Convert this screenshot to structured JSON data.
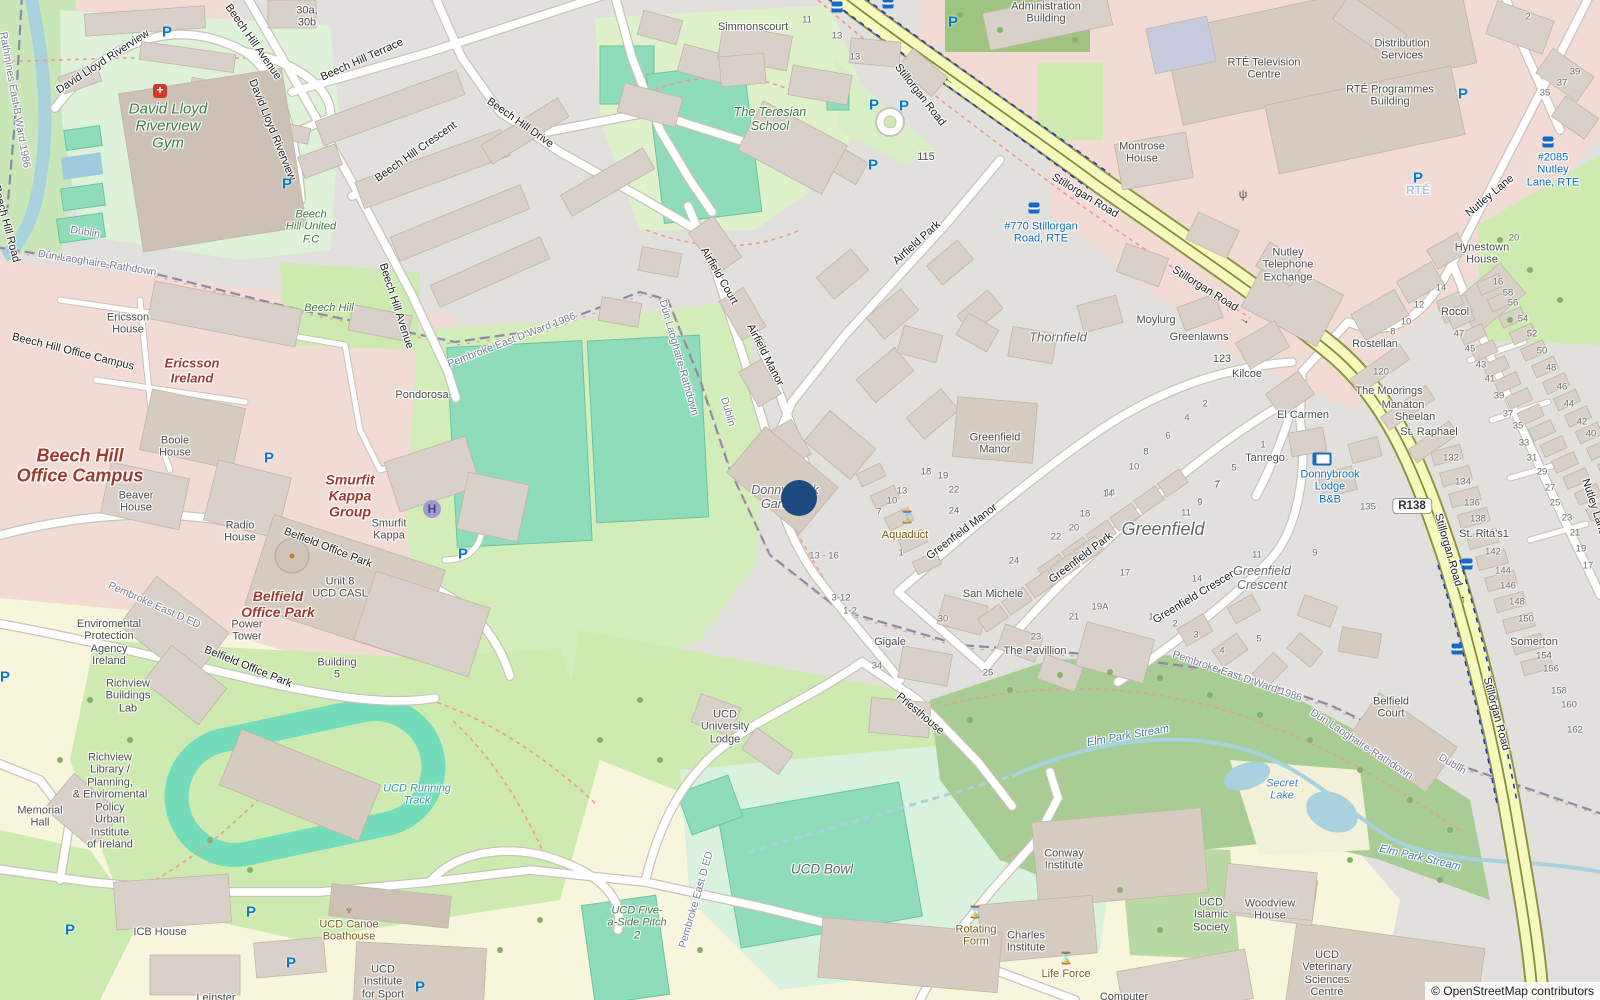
{
  "attribution": "© OpenStreetMap contributors",
  "road_ref": "R138",
  "marker": {
    "x": 799,
    "y": 498,
    "color": "#1c4980"
  },
  "colors": {
    "secondary_road": "#f5f9bb",
    "road_casing": "#8f9447",
    "pitch": "#8fdcba",
    "water": "#a9d2de",
    "commercial_pink": "#f2dbd5",
    "grass": "#cdebb0",
    "campus_yellow": "#f8f5dd",
    "wood": "#a7cd95",
    "building": "#d9d0c9"
  },
  "icon_glyphs": {
    "parking": "P",
    "helipad": "H",
    "monument": "⌛",
    "firstaid": "+",
    "antenna": "ψ",
    "boat": "♆",
    "arrow": "→"
  },
  "labels": [
    {
      "t": "David Lloyd Riverview",
      "x": 103,
      "y": 62,
      "r": -33,
      "c": "st"
    },
    {
      "t": "David Lloyd Riverview",
      "x": 272,
      "y": 130,
      "r": 68,
      "c": "st"
    },
    {
      "t": "Beech Hill Avenue",
      "x": 253,
      "y": 42,
      "r": 55,
      "c": "st"
    },
    {
      "t": "Beech Hill Avenue",
      "x": 396,
      "y": 306,
      "r": 72,
      "c": "st"
    },
    {
      "t": "Beech Hill Terrace",
      "x": 362,
      "y": 60,
      "r": -24,
      "c": "st"
    },
    {
      "t": "Beech Hill Crescent",
      "x": 416,
      "y": 152,
      "r": -35,
      "c": "st"
    },
    {
      "t": "Beech Hill Drive",
      "x": 520,
      "y": 123,
      "r": 35,
      "c": "st"
    },
    {
      "t": "Beech Hill Road",
      "x": 6,
      "y": 224,
      "r": 75,
      "c": "st"
    },
    {
      "t": "Beech Hill Office Campus",
      "x": 73,
      "y": 352,
      "r": 14,
      "c": "st"
    },
    {
      "t": "Belfield Office Park",
      "x": 328,
      "y": 548,
      "r": 21,
      "c": "st"
    },
    {
      "t": "Belfield Office Park",
      "x": 248,
      "y": 667,
      "r": 22,
      "c": "st"
    },
    {
      "t": "Stillorgan Road",
      "x": 920,
      "y": 95,
      "r": 52,
      "c": "st"
    },
    {
      "t": "Stillorgan Road",
      "x": 1085,
      "y": 196,
      "r": 31,
      "c": "st"
    },
    {
      "t": "Stillorgan Road",
      "x": 1205,
      "y": 289,
      "r": 32,
      "c": "st"
    },
    {
      "t": "Stillorgan Road",
      "x": 1448,
      "y": 550,
      "r": 74,
      "c": "st"
    },
    {
      "t": "Stillorgan Road",
      "x": 1496,
      "y": 714,
      "r": 75,
      "c": "st"
    },
    {
      "t": "Nutley Lane",
      "x": 1490,
      "y": 196,
      "r": -40,
      "c": "st"
    },
    {
      "t": "Nutley Lane",
      "x": 1594,
      "y": 507,
      "r": 72,
      "c": "st"
    },
    {
      "t": "Airfield Park",
      "x": 917,
      "y": 243,
      "r": -42,
      "c": "st"
    },
    {
      "t": "Airfield Court",
      "x": 719,
      "y": 276,
      "r": 60,
      "c": "st"
    },
    {
      "t": "Airfield Manor",
      "x": 765,
      "y": 355,
      "r": 63,
      "c": "st"
    },
    {
      "t": "Greenfield Manor",
      "x": 962,
      "y": 532,
      "r": -37,
      "c": "st"
    },
    {
      "t": "Greenfield Park",
      "x": 1081,
      "y": 558,
      "r": -37,
      "c": "st"
    },
    {
      "t": "Greenfield Crescent",
      "x": 1196,
      "y": 596,
      "r": -31,
      "c": "st"
    },
    {
      "t": "Priesthouse",
      "x": 920,
      "y": 714,
      "r": 40,
      "c": "st"
    },
    {
      "t": "Rathmines East B Ward 1986",
      "x": 14,
      "y": 100,
      "r": 80,
      "c": "bd"
    },
    {
      "t": "Dublin",
      "x": 85,
      "y": 233,
      "r": 9,
      "c": "bd"
    },
    {
      "t": "Dún Laoghaire-Rathdown",
      "x": 97,
      "y": 264,
      "r": 9,
      "c": "bd"
    },
    {
      "t": "Pembroke East D Ward 1986",
      "x": 512,
      "y": 341,
      "r": -21,
      "c": "bd"
    },
    {
      "t": "Dún Laoghaire-Rathdown",
      "x": 678,
      "y": 358,
      "r": 74,
      "c": "bd"
    },
    {
      "t": "Dublin",
      "x": 727,
      "y": 412,
      "r": 74,
      "c": "bd"
    },
    {
      "t": "Pembroke East D ED",
      "x": 154,
      "y": 606,
      "r": 24,
      "c": "bd"
    },
    {
      "t": "Pembroke East D ED",
      "x": 697,
      "y": 900,
      "r": -74,
      "c": "bd"
    },
    {
      "t": "Pembroke East D Ward 1986",
      "x": 1237,
      "y": 677,
      "r": 19,
      "c": "bd"
    },
    {
      "t": "Dún Laoghaire-Rathdown",
      "x": 1361,
      "y": 745,
      "r": 33,
      "c": "bd"
    },
    {
      "t": "Dublin",
      "x": 1452,
      "y": 765,
      "r": 31,
      "c": "bd"
    },
    {
      "t": "Simmonscourt",
      "x": 753,
      "y": 27,
      "c": "pl"
    },
    {
      "t": [
        "Administration",
        "Building"
      ],
      "x": 1046,
      "y": 13,
      "c": "pl"
    },
    {
      "t": [
        "RTÉ Television",
        "Centre"
      ],
      "x": 1264,
      "y": 69,
      "c": "pl"
    },
    {
      "t": [
        "Montrose",
        "House"
      ],
      "x": 1142,
      "y": 153,
      "c": "pl"
    },
    {
      "t": [
        "Distribution",
        "Services"
      ],
      "x": 1402,
      "y": 50,
      "c": "pl"
    },
    {
      "t": [
        "RTÉ Programmes",
        "Building"
      ],
      "x": 1390,
      "y": 96,
      "c": "pl"
    },
    {
      "t": [
        "Nutley",
        "Telephone",
        "Exchange"
      ],
      "x": 1288,
      "y": 265,
      "c": "pl"
    },
    {
      "t": [
        "Hynestown",
        "House"
      ],
      "x": 1482,
      "y": 254,
      "c": "pl"
    },
    {
      "t": "Rocol",
      "x": 1455,
      "y": 312,
      "c": "pl"
    },
    {
      "t": "Rostellan",
      "x": 1375,
      "y": 344,
      "c": "pl"
    },
    {
      "t": "The Moorings",
      "x": 1389,
      "y": 391,
      "c": "pl"
    },
    {
      "t": "Manaton",
      "x": 1403,
      "y": 405,
      "c": "pl"
    },
    {
      "t": "Sheelan",
      "x": 1415,
      "y": 417,
      "c": "pl"
    },
    {
      "t": "St. Raphael",
      "x": 1429,
      "y": 432,
      "c": "pl"
    },
    {
      "t": "St. Rita's1",
      "x": 1484,
      "y": 534,
      "c": "pl"
    },
    {
      "t": "Somerton",
      "x": 1534,
      "y": 642,
      "c": "pl"
    },
    {
      "t": "El Carmen",
      "x": 1303,
      "y": 415,
      "c": "pl"
    },
    {
      "t": "Tanrego",
      "x": 1265,
      "y": 458,
      "c": "pl"
    },
    {
      "t": "Moylurg",
      "x": 1156,
      "y": 320,
      "c": "pl"
    },
    {
      "t": "Greenlawns",
      "x": 1199,
      "y": 337,
      "c": "pl"
    },
    {
      "t": "Kilcoe",
      "x": 1247,
      "y": 374,
      "c": "pl"
    },
    {
      "t": [
        "Greenfield",
        "Manor"
      ],
      "x": 995,
      "y": 444,
      "c": "pl"
    },
    {
      "t": "San Michele",
      "x": 993,
      "y": 594,
      "c": "pl"
    },
    {
      "t": "The Pavillion",
      "x": 1035,
      "y": 651,
      "c": "pl"
    },
    {
      "t": "Gigale",
      "x": 890,
      "y": 642,
      "c": "pl"
    },
    {
      "t": "Pondorosa",
      "x": 422,
      "y": 395,
      "c": "pl"
    },
    {
      "t": [
        "30a,",
        "30b"
      ],
      "x": 307,
      "y": 17,
      "c": "pl"
    },
    {
      "t": [
        "Ericsson",
        "House"
      ],
      "x": 128,
      "y": 324,
      "c": "pl"
    },
    {
      "t": [
        "Boole",
        "House"
      ],
      "x": 175,
      "y": 447,
      "c": "pl"
    },
    {
      "t": [
        "Beaver",
        "House"
      ],
      "x": 136,
      "y": 502,
      "c": "pl"
    },
    {
      "t": [
        "Radio",
        "House"
      ],
      "x": 240,
      "y": 532,
      "c": "pl"
    },
    {
      "t": [
        "Smurfit",
        "Kappa"
      ],
      "x": 389,
      "y": 530,
      "c": "pl"
    },
    {
      "t": [
        "Unit 8",
        "UCD CASL"
      ],
      "x": 340,
      "y": 588,
      "c": "pl"
    },
    {
      "t": [
        "Power",
        "Tower"
      ],
      "x": 247,
      "y": 631,
      "c": "pl"
    },
    {
      "t": [
        "Building",
        "5"
      ],
      "x": 337,
      "y": 669,
      "c": "pl"
    },
    {
      "t": [
        "Enviromental",
        "Protection",
        "Agency",
        "Ireland"
      ],
      "x": 109,
      "y": 643,
      "c": "pl"
    },
    {
      "t": [
        "Richview",
        "Buildings",
        "Lab"
      ],
      "x": 128,
      "y": 696,
      "c": "pl"
    },
    {
      "t": [
        "Richview",
        "Library /",
        "Planning,",
        "& Enviromental",
        "Policy",
        "Urban",
        "Institute",
        "of Ireland"
      ],
      "x": 110,
      "y": 801,
      "c": "pl"
    },
    {
      "t": [
        "Memorial",
        "Hall"
      ],
      "x": 40,
      "y": 817,
      "c": "pl"
    },
    {
      "t": "ICB House",
      "x": 160,
      "y": 932,
      "c": "pl"
    },
    {
      "t": [
        "UCD",
        "Institute",
        "for Sport"
      ],
      "x": 383,
      "y": 982,
      "c": "pl"
    },
    {
      "t": "Leinster",
      "x": 216,
      "y": 998,
      "c": "pl"
    },
    {
      "t": [
        "UCD",
        "University",
        "Lodge"
      ],
      "x": 725,
      "y": 727,
      "c": "pl"
    },
    {
      "t": [
        "Conway",
        "Institute"
      ],
      "x": 1064,
      "y": 860,
      "c": "pl"
    },
    {
      "t": [
        "Charles",
        "Institute"
      ],
      "x": 1026,
      "y": 942,
      "c": "pl"
    },
    {
      "t": "Computer",
      "x": 1124,
      "y": 997,
      "c": "pl"
    },
    {
      "t": [
        "UCD",
        "Islamic",
        "Society"
      ],
      "x": 1211,
      "y": 915,
      "c": "pl"
    },
    {
      "t": [
        "Woodview",
        "House"
      ],
      "x": 1270,
      "y": 910,
      "c": "pl"
    },
    {
      "t": [
        "UCD",
        "Veterinary",
        "Sciences",
        "Centre"
      ],
      "x": 1327,
      "y": 974,
      "c": "pl"
    },
    {
      "t": [
        "Belfield",
        "Court"
      ],
      "x": 1391,
      "y": 708,
      "c": "pl"
    },
    {
      "t": [
        "David Lloyd",
        "Riverview",
        "Gym"
      ],
      "x": 168,
      "y": 127,
      "c": "gr",
      "s": 15
    },
    {
      "t": [
        "The Teresian",
        "School"
      ],
      "x": 770,
      "y": 119,
      "c": "gr",
      "s": 12.5
    },
    {
      "t": "Beech Hill",
      "x": 329,
      "y": 308,
      "c": "gr"
    },
    {
      "t": [
        "Beech",
        "Hill United",
        "F.C"
      ],
      "x": 311,
      "y": 227,
      "c": "gr"
    },
    {
      "t": [
        "UCD Five-",
        "a-Side Pitch",
        "2"
      ],
      "x": 637,
      "y": 923,
      "c": "gr"
    },
    {
      "t": [
        "Ericsson",
        "Ireland"
      ],
      "x": 192,
      "y": 371,
      "c": "mr",
      "s": 13
    },
    {
      "t": [
        "Beech Hill",
        "Office Campus"
      ],
      "x": 80,
      "y": 466,
      "c": "mr",
      "s": 18
    },
    {
      "t": [
        "Smurfit",
        "Kappa",
        "Group"
      ],
      "x": 350,
      "y": 496,
      "c": "mr",
      "s": 14
    },
    {
      "t": [
        "Belfield",
        "Office Park"
      ],
      "x": 278,
      "y": 605,
      "c": "mr",
      "s": 14
    },
    {
      "t": "Greenfield",
      "x": 1163,
      "y": 529,
      "c": "lc"
    },
    {
      "t": "Thornfield",
      "x": 1058,
      "y": 338,
      "c": "ls",
      "s": 13
    },
    {
      "t": [
        "Greenfield",
        "Crescent"
      ],
      "x": 1262,
      "y": 578,
      "c": "ls"
    },
    {
      "t": [
        "Donnybrook",
        "Gardens"
      ],
      "x": 785,
      "y": 497,
      "c": "ls"
    },
    {
      "t": "UCD Bowl",
      "x": 822,
      "y": 869,
      "c": "ls",
      "s": 13.5
    },
    {
      "t": [
        "UCD Running",
        "Track"
      ],
      "x": 417,
      "y": 795,
      "c": "tl"
    },
    {
      "t": [
        "Secret",
        "Lake"
      ],
      "x": 1282,
      "y": 790,
      "c": "wt"
    },
    {
      "t": "Elm Park Stream",
      "x": 1128,
      "y": 736,
      "r": -10,
      "c": "wt"
    },
    {
      "t": "Elm Park Stream",
      "x": 1420,
      "y": 858,
      "r": 13,
      "c": "wt"
    },
    {
      "t": [
        "#770 Stillorgan",
        "Road, RTE"
      ],
      "x": 1041,
      "y": 233,
      "c": "bp"
    },
    {
      "t": [
        "#2085",
        "Nutley",
        "Lane, RTE"
      ],
      "x": 1553,
      "y": 170,
      "c": "bp"
    },
    {
      "t": [
        "Donnybrook",
        "Lodge",
        "B&B"
      ],
      "x": 1330,
      "y": 487,
      "c": "bp"
    },
    {
      "t": "Aquaduct",
      "x": 905,
      "y": 535,
      "c": "bw"
    },
    {
      "t": [
        "Rotating",
        "Form"
      ],
      "x": 976,
      "y": 936,
      "c": "bw"
    },
    {
      "t": "Life Force",
      "x": 1066,
      "y": 974,
      "c": "bw"
    },
    {
      "t": [
        "UCD Canoe",
        "Boathouse"
      ],
      "x": 349,
      "y": 931,
      "c": "bw"
    },
    {
      "t": "RTÉ",
      "x": 1418,
      "y": 191,
      "c": "fd"
    },
    {
      "t": "115",
      "x": 926,
      "y": 157,
      "c": "pl"
    },
    {
      "t": "123",
      "x": 1222,
      "y": 359,
      "c": "pl"
    }
  ],
  "house_numbers": [
    [
      807,
      20,
      "11"
    ],
    [
      837,
      36,
      "13"
    ],
    [
      855,
      57,
      "13"
    ],
    [
      1528,
      17,
      "2"
    ],
    [
      1575,
      72,
      "39"
    ],
    [
      1562,
      83,
      "37"
    ],
    [
      1545,
      93,
      "35"
    ],
    [
      1514,
      238,
      "20"
    ],
    [
      1441,
      288,
      "14"
    ],
    [
      1498,
      282,
      "16"
    ],
    [
      1508,
      293,
      "58"
    ],
    [
      1513,
      303,
      "56"
    ],
    [
      1523,
      319,
      "54"
    ],
    [
      1532,
      334,
      "52"
    ],
    [
      1542,
      351,
      "50"
    ],
    [
      1551,
      368,
      "48"
    ],
    [
      1562,
      387,
      "46"
    ],
    [
      1569,
      404,
      "44"
    ],
    [
      1582,
      422,
      "42"
    ],
    [
      1591,
      434,
      "40"
    ],
    [
      1459,
      334,
      "47"
    ],
    [
      1470,
      349,
      "45"
    ],
    [
      1481,
      365,
      "43"
    ],
    [
      1490,
      379,
      "41"
    ],
    [
      1499,
      396,
      "39"
    ],
    [
      1508,
      414,
      "37"
    ],
    [
      1518,
      426,
      "35"
    ],
    [
      1524,
      443,
      "33"
    ],
    [
      1532,
      458,
      "31"
    ],
    [
      1542,
      472,
      "29"
    ],
    [
      1550,
      488,
      "27"
    ],
    [
      1555,
      503,
      "25"
    ],
    [
      1567,
      518,
      "23"
    ],
    [
      1575,
      533,
      "21"
    ],
    [
      1581,
      549,
      "19"
    ],
    [
      1588,
      566,
      "17"
    ],
    [
      1419,
      305,
      "12"
    ],
    [
      1406,
      322,
      "10"
    ],
    [
      1393,
      332,
      "8"
    ],
    [
      1381,
      372,
      "120"
    ],
    [
      1451,
      458,
      "132"
    ],
    [
      1463,
      482,
      "134"
    ],
    [
      1472,
      503,
      "136"
    ],
    [
      1478,
      519,
      "138"
    ],
    [
      1493,
      552,
      "142"
    ],
    [
      1503,
      571,
      "144"
    ],
    [
      1508,
      586,
      "146"
    ],
    [
      1517,
      602,
      "148"
    ],
    [
      1526,
      619,
      "150"
    ],
    [
      1544,
      656,
      "154"
    ],
    [
      1551,
      669,
      "156"
    ],
    [
      1559,
      691,
      "158"
    ],
    [
      1569,
      705,
      "160"
    ],
    [
      1575,
      730,
      "162"
    ],
    [
      1368,
      507,
      "135"
    ],
    [
      1315,
      553,
      "9"
    ],
    [
      1205,
      404,
      "2"
    ],
    [
      1187,
      418,
      "4"
    ],
    [
      1168,
      436,
      "6"
    ],
    [
      1146,
      452,
      "8"
    ],
    [
      1134,
      467,
      "10"
    ],
    [
      1110,
      493,
      "14"
    ],
    [
      1263,
      445,
      "1"
    ],
    [
      1234,
      468,
      "5"
    ],
    [
      1218,
      484,
      "7"
    ],
    [
      1200,
      502,
      "9"
    ],
    [
      926,
      472,
      "18"
    ],
    [
      943,
      476,
      "19"
    ],
    [
      954,
      490,
      "22"
    ],
    [
      902,
      491,
      "13"
    ],
    [
      892,
      501,
      "10"
    ],
    [
      879,
      512,
      "7"
    ],
    [
      954,
      511,
      "24"
    ],
    [
      901,
      553,
      "1"
    ],
    [
      824,
      556,
      "13 - 16"
    ],
    [
      841,
      598,
      "3-12"
    ],
    [
      850,
      611,
      "1-2"
    ],
    [
      943,
      619,
      "30"
    ],
    [
      877,
      666,
      "34"
    ],
    [
      1108,
      494,
      "14"
    ],
    [
      1085,
      514,
      "18"
    ],
    [
      1074,
      528,
      "20"
    ],
    [
      1056,
      537,
      "22"
    ],
    [
      1014,
      561,
      "24"
    ],
    [
      1125,
      573,
      "17"
    ],
    [
      1100,
      607,
      "19A"
    ],
    [
      1074,
      617,
      "21"
    ],
    [
      1036,
      637,
      "23"
    ],
    [
      988,
      673,
      "25"
    ],
    [
      1217,
      485,
      "7"
    ],
    [
      1200,
      503,
      "9"
    ],
    [
      1186,
      513,
      "11"
    ],
    [
      1197,
      579,
      "14"
    ],
    [
      1151,
      617,
      "1"
    ],
    [
      1175,
      624,
      "2"
    ],
    [
      1196,
      635,
      "3"
    ],
    [
      1222,
      651,
      "4"
    ],
    [
      1259,
      639,
      "5"
    ],
    [
      1257,
      555,
      "11"
    ]
  ],
  "icons": {
    "parking": [
      [
        167,
        32
      ],
      [
        287,
        184
      ],
      [
        874,
        105
      ],
      [
        904,
        106
      ],
      [
        873,
        165
      ],
      [
        953,
        22
      ],
      [
        1463,
        94
      ],
      [
        1418,
        178
      ],
      [
        269,
        458
      ],
      [
        463,
        554
      ],
      [
        5,
        677
      ],
      [
        70,
        930
      ],
      [
        251,
        912
      ],
      [
        291,
        963
      ],
      [
        420,
        987
      ]
    ],
    "bus": [
      [
        837,
        7
      ],
      [
        888,
        3
      ],
      [
        1034,
        208
      ],
      [
        1548,
        142
      ],
      [
        1467,
        564
      ],
      [
        1457,
        649
      ]
    ],
    "monument": [
      [
        907,
        517
      ],
      [
        975,
        912
      ],
      [
        1066,
        958
      ]
    ],
    "helipad": [
      [
        432,
        509
      ]
    ],
    "firstaid": [
      [
        160,
        91
      ]
    ],
    "boat": [
      [
        349,
        910
      ]
    ],
    "bed": [
      [
        1322,
        459
      ]
    ],
    "antenna": [
      [
        1243,
        194
      ]
    ],
    "arrow": [
      [
        948,
        82,
        218
      ],
      [
        1245,
        320,
        32
      ],
      [
        1462,
        600,
        258
      ]
    ]
  }
}
